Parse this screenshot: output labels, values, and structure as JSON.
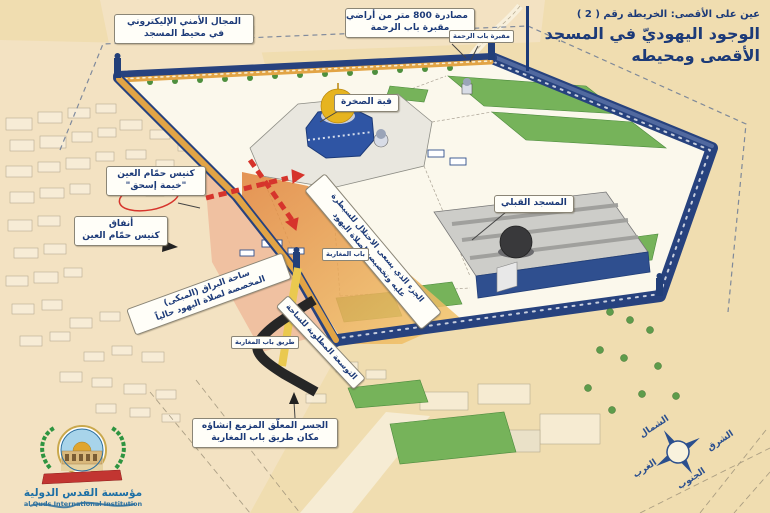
{
  "header": {
    "series_title": "عين على الأقصى: الخريطة رقم ( 2 )",
    "title_line1": "الوجود اليهوديّ في المسجد",
    "title_line2": "الأقصى ومحيطه"
  },
  "map_labels": {
    "security_zone": {
      "line1": "المجال الأمني الإليكتروني",
      "line2": "في محيط المسجد"
    },
    "land_confiscation": {
      "line1": "مصادرة 800 متر من أراضي",
      "line2": "مقبرة باب الرحمة"
    },
    "bab_rahma_cemetery": "مقبرة باب الرحمة",
    "dome_of_the_rock": "قبة الصخرة",
    "qibli_mosque": "المسجد القبلي",
    "hammam_alayn_synagogue": {
      "line1": "كنيس حمّام العين",
      "line2": "\"خيمة إسحق\""
    },
    "synagogue_tunnels": {
      "line1": "أنفاق",
      "line2": "كنيس حمّام العين"
    },
    "buraq_plaza": {
      "line1": "ساحة البراق (المبكى)",
      "line2": "المخصصة لصلاة اليهود حالياً"
    },
    "targeted_section": {
      "line1": "الجزء الذي يسعى الاحتلال للسيطرة",
      "line2": "عليه وتخصيصه لصلاة اليهود"
    },
    "plaza_expansion": "التوسعة المطلوبة للساحة",
    "maghariba_gate": "باب المغاربة",
    "maghariba_road": "طريق باب المغاربة",
    "suspended_bridge": {
      "line1": "الجسر المعلّق المزمع إنشاؤه",
      "line2": "مكان طريق باب المغاربة"
    }
  },
  "compass": {
    "north": "الشمال",
    "east": "الشرق",
    "west": "الغرب",
    "south": "الجنوب"
  },
  "footer": {
    "org_name_ar": "مؤسسة القدس الدولية",
    "org_name_en": "al Quds International Institution"
  },
  "colors": {
    "title_blue": "#1c3a78",
    "wall_navy": "#27427e",
    "wall_gold": "#e2a445",
    "strip_orange": "#e78f3f",
    "overlay_salmon": "#eda07f",
    "lawn_green": "#76b35a",
    "alert_red": "#d6342c",
    "background": "#f0ddb0",
    "logo_green": "#2e9440",
    "logo_red": "#c23531",
    "footer_teal": "#1d6fa5"
  }
}
